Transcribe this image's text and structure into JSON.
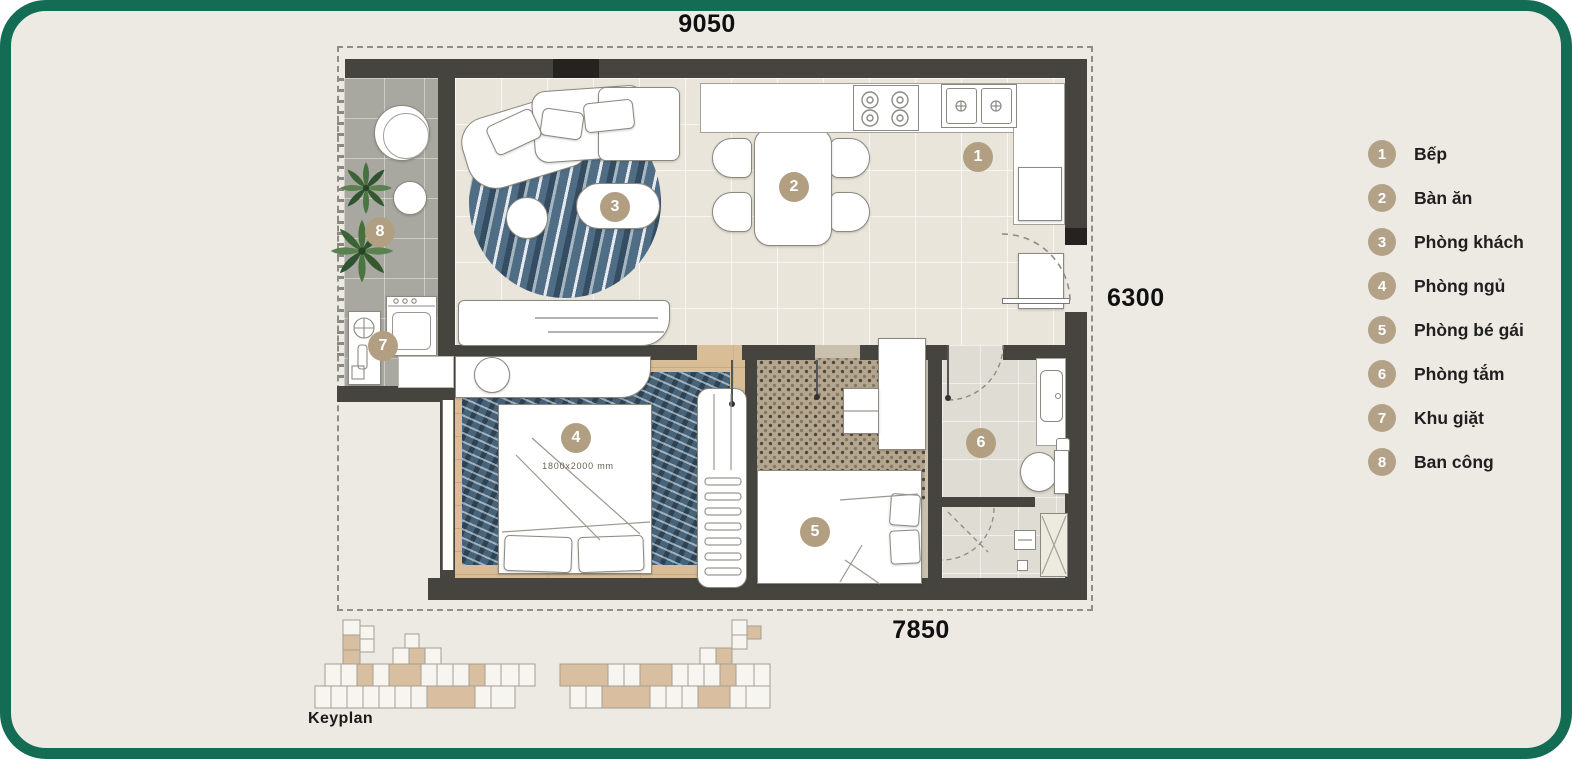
{
  "colors": {
    "frame_green": "#146C55",
    "panel_background": "#ECEAE3",
    "badge_tan": "#B29F82",
    "legend_circle_tan": "#B3A287",
    "wall_gray": "#45443F",
    "wood_floor": "#D9BD97",
    "rug_blue": "#47637A"
  },
  "dimensions": {
    "top": "9050",
    "right": "6300",
    "bottom": "7850"
  },
  "legend": {
    "items": [
      {
        "num": "1",
        "label": "Bếp"
      },
      {
        "num": "2",
        "label": "Bàn ăn"
      },
      {
        "num": "3",
        "label": "Phòng khách"
      },
      {
        "num": "4",
        "label": "Phòng ngủ"
      },
      {
        "num": "5",
        "label": "Phòng bé gái"
      },
      {
        "num": "6",
        "label": "Phòng tắm"
      },
      {
        "num": "7",
        "label": "Khu giặt"
      },
      {
        "num": "8",
        "label": "Ban công"
      }
    ]
  },
  "plan": {
    "badges": [
      "1",
      "2",
      "3",
      "4",
      "5",
      "6",
      "7",
      "8"
    ],
    "bed_size_label": "1800x2000 mm"
  },
  "keyplan": {
    "label": "Keyplan"
  }
}
